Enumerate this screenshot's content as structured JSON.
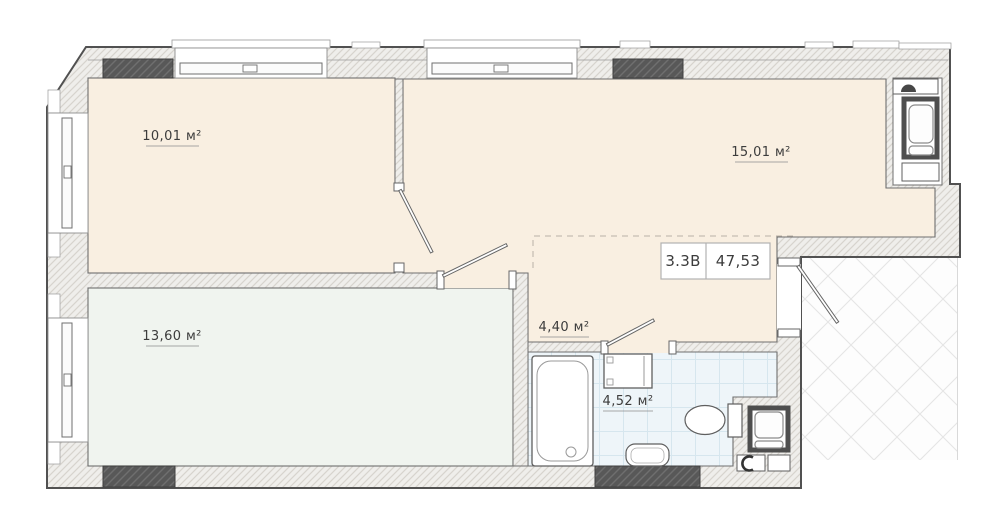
{
  "plan": {
    "unit": {
      "type_label": "3.3В",
      "total_area": "47,53"
    },
    "rooms": [
      {
        "name": "bedroom-top-left",
        "area": "10,01 м²"
      },
      {
        "name": "kitchen-living",
        "area": "15,01 м²"
      },
      {
        "name": "bedroom-bottom",
        "area": "13,60 м²"
      },
      {
        "name": "hallway",
        "area": "4,40 м²"
      },
      {
        "name": "bathroom",
        "area": "4,52 м²"
      }
    ],
    "colors": {
      "room_fill": "#f9efe1",
      "bottom_room_fill": "#f0f4ef",
      "bathroom_fill": "#eef5f9",
      "wall_block": "#565656",
      "wall_hatch_base": "#efeeeb"
    }
  }
}
